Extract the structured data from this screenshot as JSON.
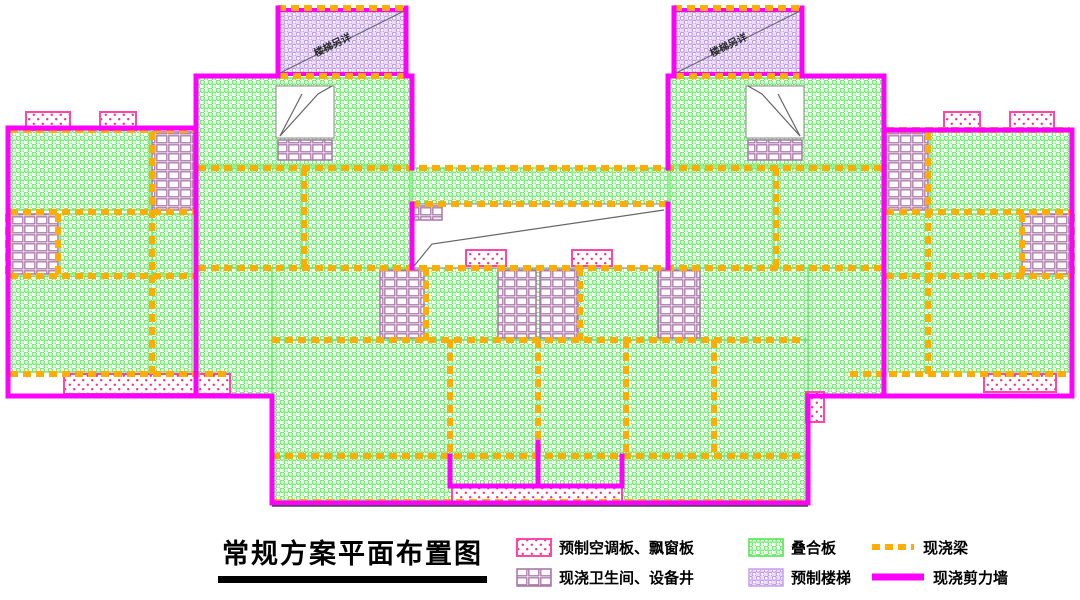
{
  "title": {
    "text": "常规方案平面布置图"
  },
  "legend": {
    "items": [
      {
        "key": "precast-ac-bay-panel",
        "swatch": "pink-dots",
        "label": "预制空调板、飘窗板"
      },
      {
        "key": "composite-slab",
        "swatch": "green-hex",
        "label": "叠合板"
      },
      {
        "key": "cast-insitu-beam",
        "swatch": "orange-dash",
        "label": "现浇梁"
      },
      {
        "key": "cast-bathroom-shaft",
        "swatch": "purple-grid",
        "label": "现浇卫生间、设备井"
      },
      {
        "key": "precast-stair",
        "swatch": "lavender-dots",
        "label": "预制楼梯"
      },
      {
        "key": "cast-shear-wall",
        "swatch": "magenta-line",
        "label": "现浇剪力墙"
      }
    ]
  },
  "colors": {
    "shear_wall": "#FF00FF",
    "beam": "#FFAD00",
    "green_border": "#52E852",
    "green_pattern": "#5EE85E",
    "grid_line": "#A879A8",
    "pink_border": "#FF47A3",
    "pink_dot": "#EE2F90",
    "stair_pattern": "#B88CE6",
    "stair_bg": "#EADCFA",
    "leader": "#666666",
    "label_text": "#2B2B2B"
  },
  "plan": {
    "width": 1080,
    "height": 520,
    "regions": [
      {
        "type": "green",
        "x": 198,
        "y": 78,
        "w": 212,
        "h": 88
      },
      {
        "type": "green",
        "x": 670,
        "y": 78,
        "w": 212,
        "h": 88
      },
      {
        "type": "green",
        "x": 198,
        "y": 168,
        "w": 104,
        "h": 100
      },
      {
        "type": "green",
        "x": 306,
        "y": 168,
        "w": 104,
        "h": 100
      },
      {
        "type": "green",
        "x": 670,
        "y": 168,
        "w": 104,
        "h": 100
      },
      {
        "type": "green",
        "x": 778,
        "y": 168,
        "w": 104,
        "h": 100
      },
      {
        "type": "green",
        "x": 412,
        "y": 168,
        "w": 256,
        "h": 36
      },
      {
        "type": "green",
        "x": 10,
        "y": 130,
        "w": 140,
        "h": 80
      },
      {
        "type": "green",
        "x": 60,
        "y": 214,
        "w": 132,
        "h": 60
      },
      {
        "type": "green",
        "x": 152,
        "y": 214,
        "w": 40,
        "h": 60
      },
      {
        "type": "green",
        "x": 10,
        "y": 276,
        "w": 182,
        "h": 96
      },
      {
        "type": "green",
        "x": 930,
        "y": 130,
        "w": 140,
        "h": 80
      },
      {
        "type": "green",
        "x": 888,
        "y": 214,
        "w": 132,
        "h": 60
      },
      {
        "type": "green",
        "x": 198,
        "y": 268,
        "w": 74,
        "h": 128
      },
      {
        "type": "green",
        "x": 808,
        "y": 268,
        "w": 74,
        "h": 128
      },
      {
        "type": "green",
        "x": 888,
        "y": 276,
        "w": 182,
        "h": 96
      },
      {
        "type": "green",
        "x": 272,
        "y": 268,
        "w": 536,
        "h": 72
      },
      {
        "type": "green",
        "x": 272,
        "y": 340,
        "w": 536,
        "h": 116
      },
      {
        "type": "green",
        "x": 274,
        "y": 456,
        "w": 532,
        "h": 46
      },
      {
        "type": "stair",
        "x": 278,
        "y": 10,
        "w": 128,
        "h": 64
      },
      {
        "type": "stair",
        "x": 674,
        "y": 10,
        "w": 128,
        "h": 64
      },
      {
        "type": "grid",
        "x": 152,
        "y": 132,
        "w": 42,
        "h": 78
      },
      {
        "type": "grid",
        "x": 10,
        "y": 214,
        "w": 48,
        "h": 60
      },
      {
        "type": "grid",
        "x": 886,
        "y": 132,
        "w": 42,
        "h": 78
      },
      {
        "type": "grid",
        "x": 1022,
        "y": 214,
        "w": 48,
        "h": 60
      },
      {
        "type": "void",
        "x": 276,
        "y": 86,
        "w": 58,
        "h": 52
      },
      {
        "type": "grid",
        "x": 278,
        "y": 140,
        "w": 54,
        "h": 20
      },
      {
        "type": "void",
        "x": 746,
        "y": 86,
        "w": 58,
        "h": 52
      },
      {
        "type": "grid",
        "x": 748,
        "y": 140,
        "w": 54,
        "h": 20
      },
      {
        "type": "void",
        "x": 412,
        "y": 204,
        "w": 256,
        "h": 64
      },
      {
        "type": "grid",
        "x": 414,
        "y": 206,
        "w": 28,
        "h": 14
      },
      {
        "type": "pink",
        "x": 466,
        "y": 250,
        "w": 40,
        "h": 16
      },
      {
        "type": "pink",
        "x": 572,
        "y": 250,
        "w": 40,
        "h": 16
      },
      {
        "type": "grid",
        "x": 380,
        "y": 270,
        "w": 44,
        "h": 68
      },
      {
        "type": "grid",
        "x": 498,
        "y": 270,
        "w": 38,
        "h": 68
      },
      {
        "type": "grid",
        "x": 540,
        "y": 270,
        "w": 38,
        "h": 68
      },
      {
        "type": "grid",
        "x": 658,
        "y": 270,
        "w": 42,
        "h": 68
      },
      {
        "type": "pink",
        "x": 452,
        "y": 486,
        "w": 170,
        "h": 17
      },
      {
        "type": "pink",
        "x": 26,
        "y": 112,
        "w": 44,
        "h": 18
      },
      {
        "type": "pink",
        "x": 100,
        "y": 112,
        "w": 36,
        "h": 18
      },
      {
        "type": "pink",
        "x": 944,
        "y": 112,
        "w": 36,
        "h": 18
      },
      {
        "type": "pink",
        "x": 1010,
        "y": 112,
        "w": 44,
        "h": 18
      },
      {
        "type": "pink",
        "x": 64,
        "y": 374,
        "w": 166,
        "h": 20
      },
      {
        "type": "pink",
        "x": 984,
        "y": 374,
        "w": 72,
        "h": 18
      },
      {
        "type": "pink",
        "x": 806,
        "y": 392,
        "w": 18,
        "h": 30
      }
    ],
    "beams": {
      "h": [
        [
          278,
          406,
          8
        ],
        [
          674,
          802,
          8
        ],
        [
          280,
          404,
          76
        ],
        [
          676,
          800,
          76
        ],
        [
          10,
          194,
          130
        ],
        [
          886,
          1070,
          130
        ],
        [
          198,
          882,
          168
        ],
        [
          412,
          668,
          204
        ],
        [
          10,
          194,
          212
        ],
        [
          886,
          1070,
          212
        ],
        [
          198,
          882,
          268
        ],
        [
          10,
          194,
          276
        ],
        [
          886,
          1070,
          276
        ],
        [
          272,
          806,
          340
        ],
        [
          10,
          230,
          374
        ],
        [
          850,
          1070,
          374
        ],
        [
          272,
          806,
          456
        ],
        [
          274,
          806,
          502
        ]
      ],
      "v": [
        [
          58,
          214,
          276
        ],
        [
          1022,
          214,
          276
        ],
        [
          152,
          132,
          374
        ],
        [
          928,
          132,
          374
        ],
        [
          304,
          168,
          268
        ],
        [
          776,
          168,
          268
        ],
        [
          426,
          268,
          340
        ],
        [
          580,
          268,
          340
        ],
        [
          450,
          340,
          456
        ],
        [
          538,
          340,
          456
        ],
        [
          626,
          340,
          456
        ],
        [
          714,
          340,
          456
        ],
        [
          8,
          214,
          276
        ],
        [
          1072,
          214,
          276
        ]
      ]
    },
    "walls": [
      [
        8,
        128,
        196,
        128
      ],
      [
        8,
        128,
        8,
        396
      ],
      [
        8,
        396,
        272,
        396
      ],
      [
        272,
        396,
        272,
        503
      ],
      [
        272,
        503,
        808,
        503
      ],
      [
        808,
        396,
        808,
        503
      ],
      [
        808,
        396,
        1072,
        396
      ],
      [
        1072,
        130,
        1072,
        396
      ],
      [
        884,
        130,
        1072,
        130
      ],
      [
        884,
        76,
        884,
        130
      ],
      [
        802,
        76,
        884,
        76
      ],
      [
        802,
        8,
        802,
        76
      ],
      [
        674,
        8,
        674,
        76
      ],
      [
        668,
        76,
        674,
        76
      ],
      [
        668,
        76,
        668,
        168
      ],
      [
        412,
        76,
        412,
        168
      ],
      [
        406,
        76,
        412,
        76
      ],
      [
        406,
        8,
        406,
        76
      ],
      [
        278,
        8,
        278,
        76
      ],
      [
        196,
        76,
        278,
        76
      ],
      [
        196,
        76,
        196,
        128
      ],
      [
        196,
        130,
        196,
        396
      ],
      [
        884,
        130,
        884,
        396
      ],
      [
        412,
        204,
        412,
        268
      ],
      [
        668,
        204,
        668,
        268
      ],
      [
        450,
        456,
        450,
        486
      ],
      [
        622,
        456,
        622,
        486
      ],
      [
        450,
        486,
        538,
        486
      ],
      [
        538,
        486,
        622,
        486
      ],
      [
        538,
        442,
        538,
        486
      ]
    ],
    "leaders": [
      [
        [
          280,
          73
        ],
        [
          404,
          11
        ]
      ],
      [
        [
          676,
          73
        ],
        [
          800,
          11
        ]
      ],
      [
        [
          414,
          266
        ],
        [
          432,
          244
        ],
        [
          664,
          210
        ]
      ],
      [
        [
          280,
          136
        ],
        [
          318,
          94
        ],
        [
          332,
          86
        ]
      ],
      [
        [
          280,
          136
        ],
        [
          302,
          94
        ]
      ],
      [
        [
          800,
          136
        ],
        [
          762,
          94
        ],
        [
          748,
          86
        ]
      ],
      [
        [
          800,
          136
        ],
        [
          778,
          94
        ]
      ]
    ],
    "dark_lines": [
      [
        272,
        506,
        808,
        506
      ]
    ],
    "stair_labels": [
      {
        "text": "楼梯另详",
        "x": 334,
        "y": 48,
        "angle": -26
      },
      {
        "text": "楼梯另详",
        "x": 730,
        "y": 48,
        "angle": -26
      }
    ]
  }
}
